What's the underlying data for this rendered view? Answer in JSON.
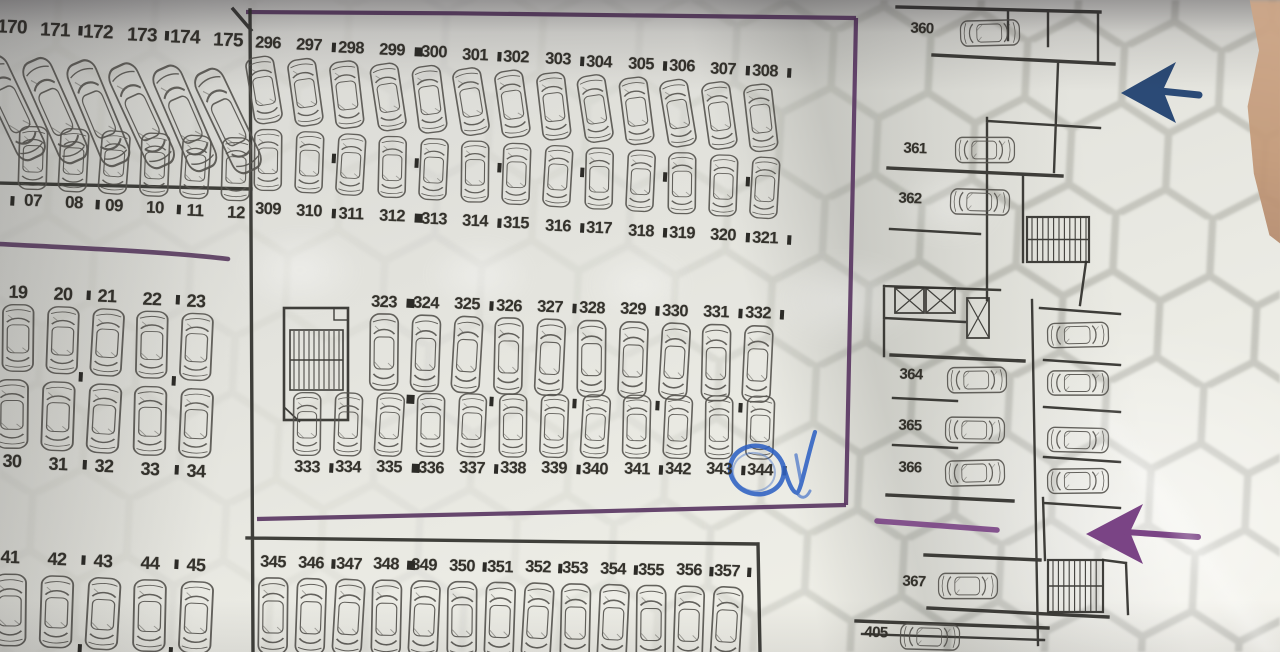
{
  "parking_plan": {
    "left_blocks": {
      "row_170s": [
        "170",
        "171",
        "172",
        "173",
        "174",
        "175"
      ],
      "row_00s": [
        "07",
        "08",
        "09",
        "10",
        "11",
        "12"
      ],
      "row_teens": [
        "19",
        "20",
        "21",
        "22",
        "23"
      ],
      "row_30s": [
        "30",
        "31",
        "32",
        "33",
        "34"
      ],
      "row_40s": [
        "41",
        "42",
        "43",
        "44",
        "45"
      ]
    },
    "highlight_block": {
      "row_296_308": [
        "296",
        "297",
        "298",
        "299",
        "300",
        "301",
        "302",
        "303",
        "304",
        "305",
        "306",
        "307",
        "308"
      ],
      "row_309_321": [
        "309",
        "310",
        "311",
        "312",
        "313",
        "314",
        "315",
        "316",
        "317",
        "318",
        "319",
        "320",
        "321"
      ],
      "row_323_332": [
        "323",
        "324",
        "325",
        "326",
        "327",
        "328",
        "329",
        "330",
        "331",
        "332"
      ],
      "row_333_344": [
        "333",
        "334",
        "335",
        "336",
        "337",
        "338",
        "339",
        "340",
        "341",
        "342",
        "343",
        "344"
      ],
      "row_345_357": [
        "345",
        "346",
        "347",
        "348",
        "349",
        "350",
        "351",
        "352",
        "353",
        "354",
        "355",
        "356",
        "357"
      ]
    },
    "separators": {
      "row_170s": {
        "after": [
          1,
          3
        ]
      },
      "row_00s": {
        "after": [
          1,
          3
        ],
        "before": true
      },
      "row_teens": {
        "after": [
          1,
          3
        ]
      },
      "row_30s": {
        "after": [
          1,
          3
        ]
      },
      "row_40s": {
        "after": [
          1,
          3
        ]
      },
      "row_296_308": {
        "after": [
          1,
          3,
          5,
          7,
          9,
          11,
          12
        ],
        "big": [
          3
        ]
      },
      "row_309_321": {
        "after": [
          1,
          3,
          5,
          7,
          9,
          11,
          12
        ],
        "big": [
          3
        ]
      },
      "row_323_332": {
        "after": [
          0,
          2,
          4,
          6,
          8,
          9
        ],
        "big": [
          0
        ]
      },
      "row_333_344": {
        "after": [
          0,
          2,
          4,
          6,
          8,
          10,
          11
        ],
        "big": [
          2
        ]
      },
      "row_345_357": {
        "after": [
          1,
          3,
          5,
          7,
          9,
          11,
          12
        ],
        "big": [
          3
        ]
      }
    },
    "right_wing_spaces": [
      "360",
      "361",
      "362",
      "364",
      "365",
      "366",
      "367",
      "405"
    ],
    "annotations": {
      "circled_space": "344",
      "pen_mark": "check"
    },
    "colors": {
      "boundary_purple": "#5a3763",
      "arrow_blue": "#2b4a76",
      "arrow_purple": "#7a4485",
      "pen_blue": "#2f62c4",
      "wall_ink": "#32312d",
      "car_ink": "#55534e",
      "paper": "#e7e7e0"
    }
  }
}
